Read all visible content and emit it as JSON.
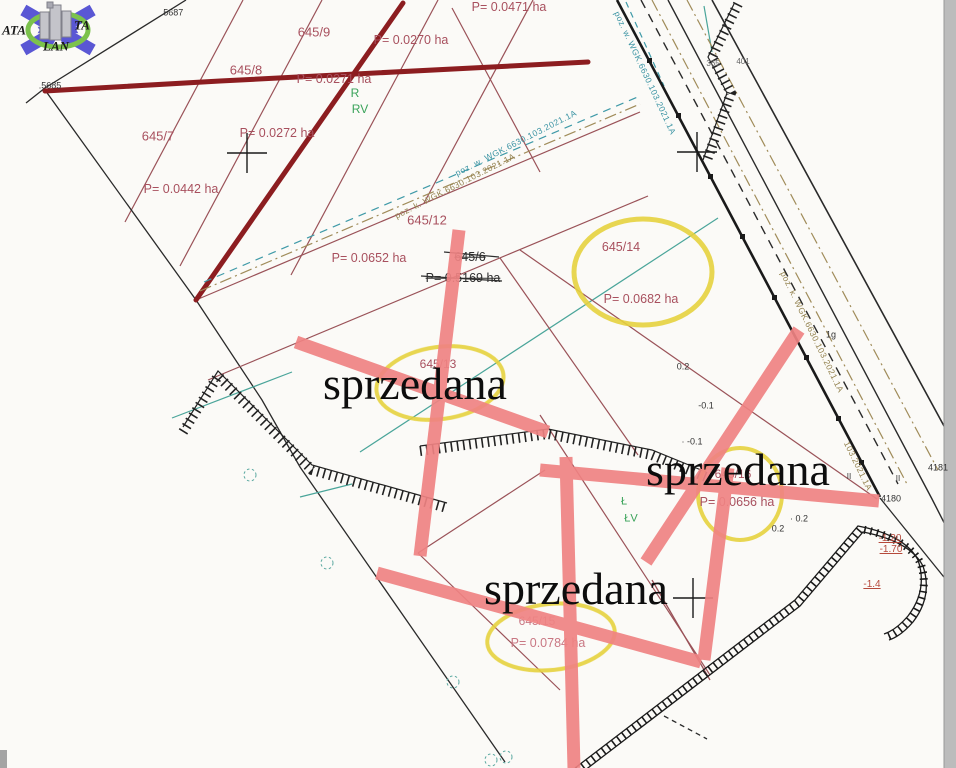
{
  "map": {
    "type": "cadastral-survey-map",
    "sold_text": "sprzedana",
    "colors": {
      "sold_bar": "#ef8383",
      "highlight_ellipse": "#e6d23e",
      "parcel_line": "#9a5258",
      "thick_boundary": "#8c1d20",
      "teal_line": "#4aa59a",
      "olive_line": "#a08c5a",
      "logo_arrow": "#5a57d4",
      "logo_ring": "#7cc24c"
    },
    "parcels": [
      {
        "number": "645/7",
        "area": "P= 0.0442 ha"
      },
      {
        "number": "645/8",
        "area": "P= 0.0271 ha"
      },
      {
        "number": "645/9",
        "area": "P= 0.0270 ha"
      },
      {
        "number": "645/12",
        "area": "P= 0.0652 ha"
      },
      {
        "number": "645/13",
        "area": null,
        "sold": true
      },
      {
        "number": "645/14",
        "area": "P= 0.0682 ha"
      },
      {
        "number": "645/15",
        "area": "P= 0.0784 ha",
        "sold": true
      },
      {
        "number": "645/16",
        "area": "P= 0.0656 ha",
        "sold": true
      },
      {
        "number": "645/6",
        "area": "P= 0.5169 ha",
        "struck": true
      }
    ]
  },
  "labels": [
    {
      "name": "logo-text-ata",
      "text": "ATA",
      "x": 14,
      "y": 30,
      "cls": "wm"
    },
    {
      "name": "logo-text-ta",
      "text": "TA",
      "x": 82,
      "y": 25,
      "cls": "wm"
    },
    {
      "name": "logo-text-lan",
      "text": "LAN",
      "x": 56,
      "y": 46,
      "cls": "wm"
    },
    {
      "name": "point-5687",
      "text": ".5687",
      "x": 172,
      "y": 13,
      "cls": "blk",
      "fs": 9
    },
    {
      "name": "point-5685",
      "text": ".5685",
      "x": 50,
      "y": 86,
      "cls": "blk",
      "fs": 9
    },
    {
      "name": "parcel-645-9",
      "text": "645/9",
      "x": 314,
      "y": 32,
      "cls": "red",
      "fs": 13
    },
    {
      "name": "area-645-9",
      "text": "P= 0.0270 ha",
      "x": 411,
      "y": 40,
      "cls": "red",
      "fs": 12.5
    },
    {
      "name": "parcel-645-8",
      "text": "645/8",
      "x": 246,
      "y": 70,
      "cls": "red",
      "fs": 13
    },
    {
      "name": "area-645-8",
      "text": "P= 0.0271 ha",
      "x": 334,
      "y": 79,
      "cls": "red",
      "fs": 12.5
    },
    {
      "name": "landuse-r",
      "text": "R",
      "x": 355,
      "y": 93,
      "cls": "grn",
      "fs": 12
    },
    {
      "name": "landuse-rv",
      "text": "RV",
      "x": 360,
      "y": 109,
      "cls": "grn",
      "fs": 12
    },
    {
      "name": "parcel-645-7",
      "text": "645/7",
      "x": 158,
      "y": 136,
      "cls": "red",
      "fs": 13
    },
    {
      "name": "area-645-7b",
      "text": "P= 0.0272 ha",
      "x": 277,
      "y": 133,
      "cls": "red",
      "fs": 12.5
    },
    {
      "name": "area-645-7",
      "text": "P= 0.0442 ha",
      "x": 181,
      "y": 189,
      "cls": "red",
      "fs": 12.5
    },
    {
      "name": "area-top",
      "text": "P= 0.0471 ha",
      "x": 509,
      "y": 7,
      "cls": "red",
      "fs": 12.5
    },
    {
      "name": "parcel-645-12",
      "text": "645/12",
      "x": 427,
      "y": 220,
      "cls": "red",
      "fs": 13
    },
    {
      "name": "area-645-12",
      "text": "P= 0.0652 ha",
      "x": 369,
      "y": 258,
      "cls": "red",
      "fs": 12.5
    },
    {
      "name": "parcel-645-6-struck",
      "text": "645/6",
      "x": 470,
      "y": 257,
      "cls": "struck",
      "fs": 12.5
    },
    {
      "name": "area-645-6-struck",
      "text": "P= 0.5169 ha",
      "x": 463,
      "y": 278,
      "cls": "struck",
      "fs": 12.5
    },
    {
      "name": "parcel-645-14",
      "text": "645/14",
      "x": 621,
      "y": 247,
      "cls": "red",
      "fs": 12.5
    },
    {
      "name": "area-645-14",
      "text": "P= 0.0682 ha",
      "x": 641,
      "y": 299,
      "cls": "red",
      "fs": 12.5
    },
    {
      "name": "parcel-645-13",
      "text": "645/13",
      "x": 438,
      "y": 364,
      "cls": "red",
      "fs": 12
    },
    {
      "name": "parcel-645-16",
      "text": "645/16",
      "x": 733,
      "y": 474,
      "cls": "red",
      "fs": 12
    },
    {
      "name": "area-645-16",
      "text": "P= 0.0656 ha",
      "x": 737,
      "y": 502,
      "cls": "red",
      "fs": 12.5
    },
    {
      "name": "parcel-645-15",
      "text": "645/15",
      "x": 537,
      "y": 621,
      "cls": "pink",
      "fs": 12
    },
    {
      "name": "area-645-15",
      "text": "P= 0.0784 ha",
      "x": 548,
      "y": 643,
      "cls": "pink",
      "fs": 12.5
    },
    {
      "name": "landuse-l",
      "text": "Ł",
      "x": 624,
      "y": 502,
      "cls": "grn",
      "fs": 11
    },
    {
      "name": "landuse-lv",
      "text": "ŁV",
      "x": 631,
      "y": 519,
      "cls": "grn",
      "fs": 11
    },
    {
      "name": "spot-height-02a",
      "text": "0.2",
      "x": 683,
      "y": 367,
      "cls": "blk",
      "fs": 9
    },
    {
      "name": "spot-height-01a",
      "text": "-0.1",
      "x": 706,
      "y": 406,
      "cls": "blk",
      "fs": 9
    },
    {
      "name": "spot-height-01b",
      "text": "· -0.1",
      "x": 692,
      "y": 442,
      "cls": "blk",
      "fs": 9
    },
    {
      "name": "spot-height-02b",
      "text": "0.2",
      "x": 778,
      "y": 529,
      "cls": "blk",
      "fs": 9
    },
    {
      "name": "spot-height-02c",
      "text": "· 0.2",
      "x": 799,
      "y": 519,
      "cls": "blk",
      "fs": 9
    },
    {
      "name": "point-4181",
      "text": "4181",
      "x": 938,
      "y": 468,
      "cls": "blk",
      "fs": 9
    },
    {
      "name": "point-4180",
      "text": "4180",
      "x": 891,
      "y": 499,
      "cls": "blk",
      "fs": 9
    },
    {
      "name": "elevation-120",
      "text": "-1.20",
      "x": 890,
      "y": 539,
      "cls": "elev",
      "fs": 10
    },
    {
      "name": "elevation-170",
      "text": "-1.70",
      "x": 891,
      "y": 550,
      "cls": "elev",
      "fs": 10
    },
    {
      "name": "elevation-140",
      "text": "-1.4",
      "x": 872,
      "y": 585,
      "cls": "elev",
      "fs": 10
    },
    {
      "name": "point-365",
      "text": "365",
      "x": 713,
      "y": 64,
      "cls": "gry",
      "fs": 8
    },
    {
      "name": "point-401",
      "text": "401",
      "x": 743,
      "y": 62,
      "cls": "gry",
      "fs": 8
    },
    {
      "name": "mark-1g",
      "text": "1g",
      "x": 831,
      "y": 335,
      "cls": "blk",
      "fs": 9
    },
    {
      "name": "mark-ii-1",
      "text": "II",
      "x": 849,
      "y": 477,
      "cls": "blk",
      "fs": 8
    },
    {
      "name": "mark-ii-2",
      "text": "II",
      "x": 898,
      "y": 479,
      "cls": "blk",
      "fs": 8
    },
    {
      "name": "doc-ref-teal-band",
      "text": "poz. w. WGK.6630.103.2021.1A",
      "x": 516,
      "y": 143,
      "cls": "teal",
      "fs": 8.5,
      "rot": -27
    },
    {
      "name": "doc-ref-olive-band",
      "text": "poz. k. WGK.6630.103.2021.1A",
      "x": 455,
      "y": 186,
      "cls": "olv",
      "fs": 8.5,
      "rot": -27
    },
    {
      "name": "doc-ref-teal-road",
      "text": "poz. w. WGK.6630.103.2021.1A",
      "x": 645,
      "y": 73,
      "cls": "teal",
      "fs": 8.5,
      "rot": 65
    },
    {
      "name": "doc-ref-olive-road",
      "text": "poz. k. WGK.6630.103.2021.1A",
      "x": 812,
      "y": 332,
      "cls": "olv",
      "fs": 8.5,
      "rot": 64
    },
    {
      "name": "doc-ref-olive-road-2",
      "text": "103.2021.1A",
      "x": 858,
      "y": 466,
      "cls": "olv",
      "fs": 8.5,
      "rot": 64
    },
    {
      "name": "sold-stamp-1",
      "text": "sprzedana",
      "x": 415,
      "y": 384,
      "cls": "sold",
      "layer": "sold"
    },
    {
      "name": "sold-stamp-2",
      "text": "sprzedana",
      "x": 738,
      "y": 470,
      "cls": "sold",
      "layer": "sold"
    },
    {
      "name": "sold-stamp-3",
      "text": "sprzedana",
      "x": 576,
      "y": 589,
      "cls": "sold",
      "layer": "sold"
    }
  ]
}
